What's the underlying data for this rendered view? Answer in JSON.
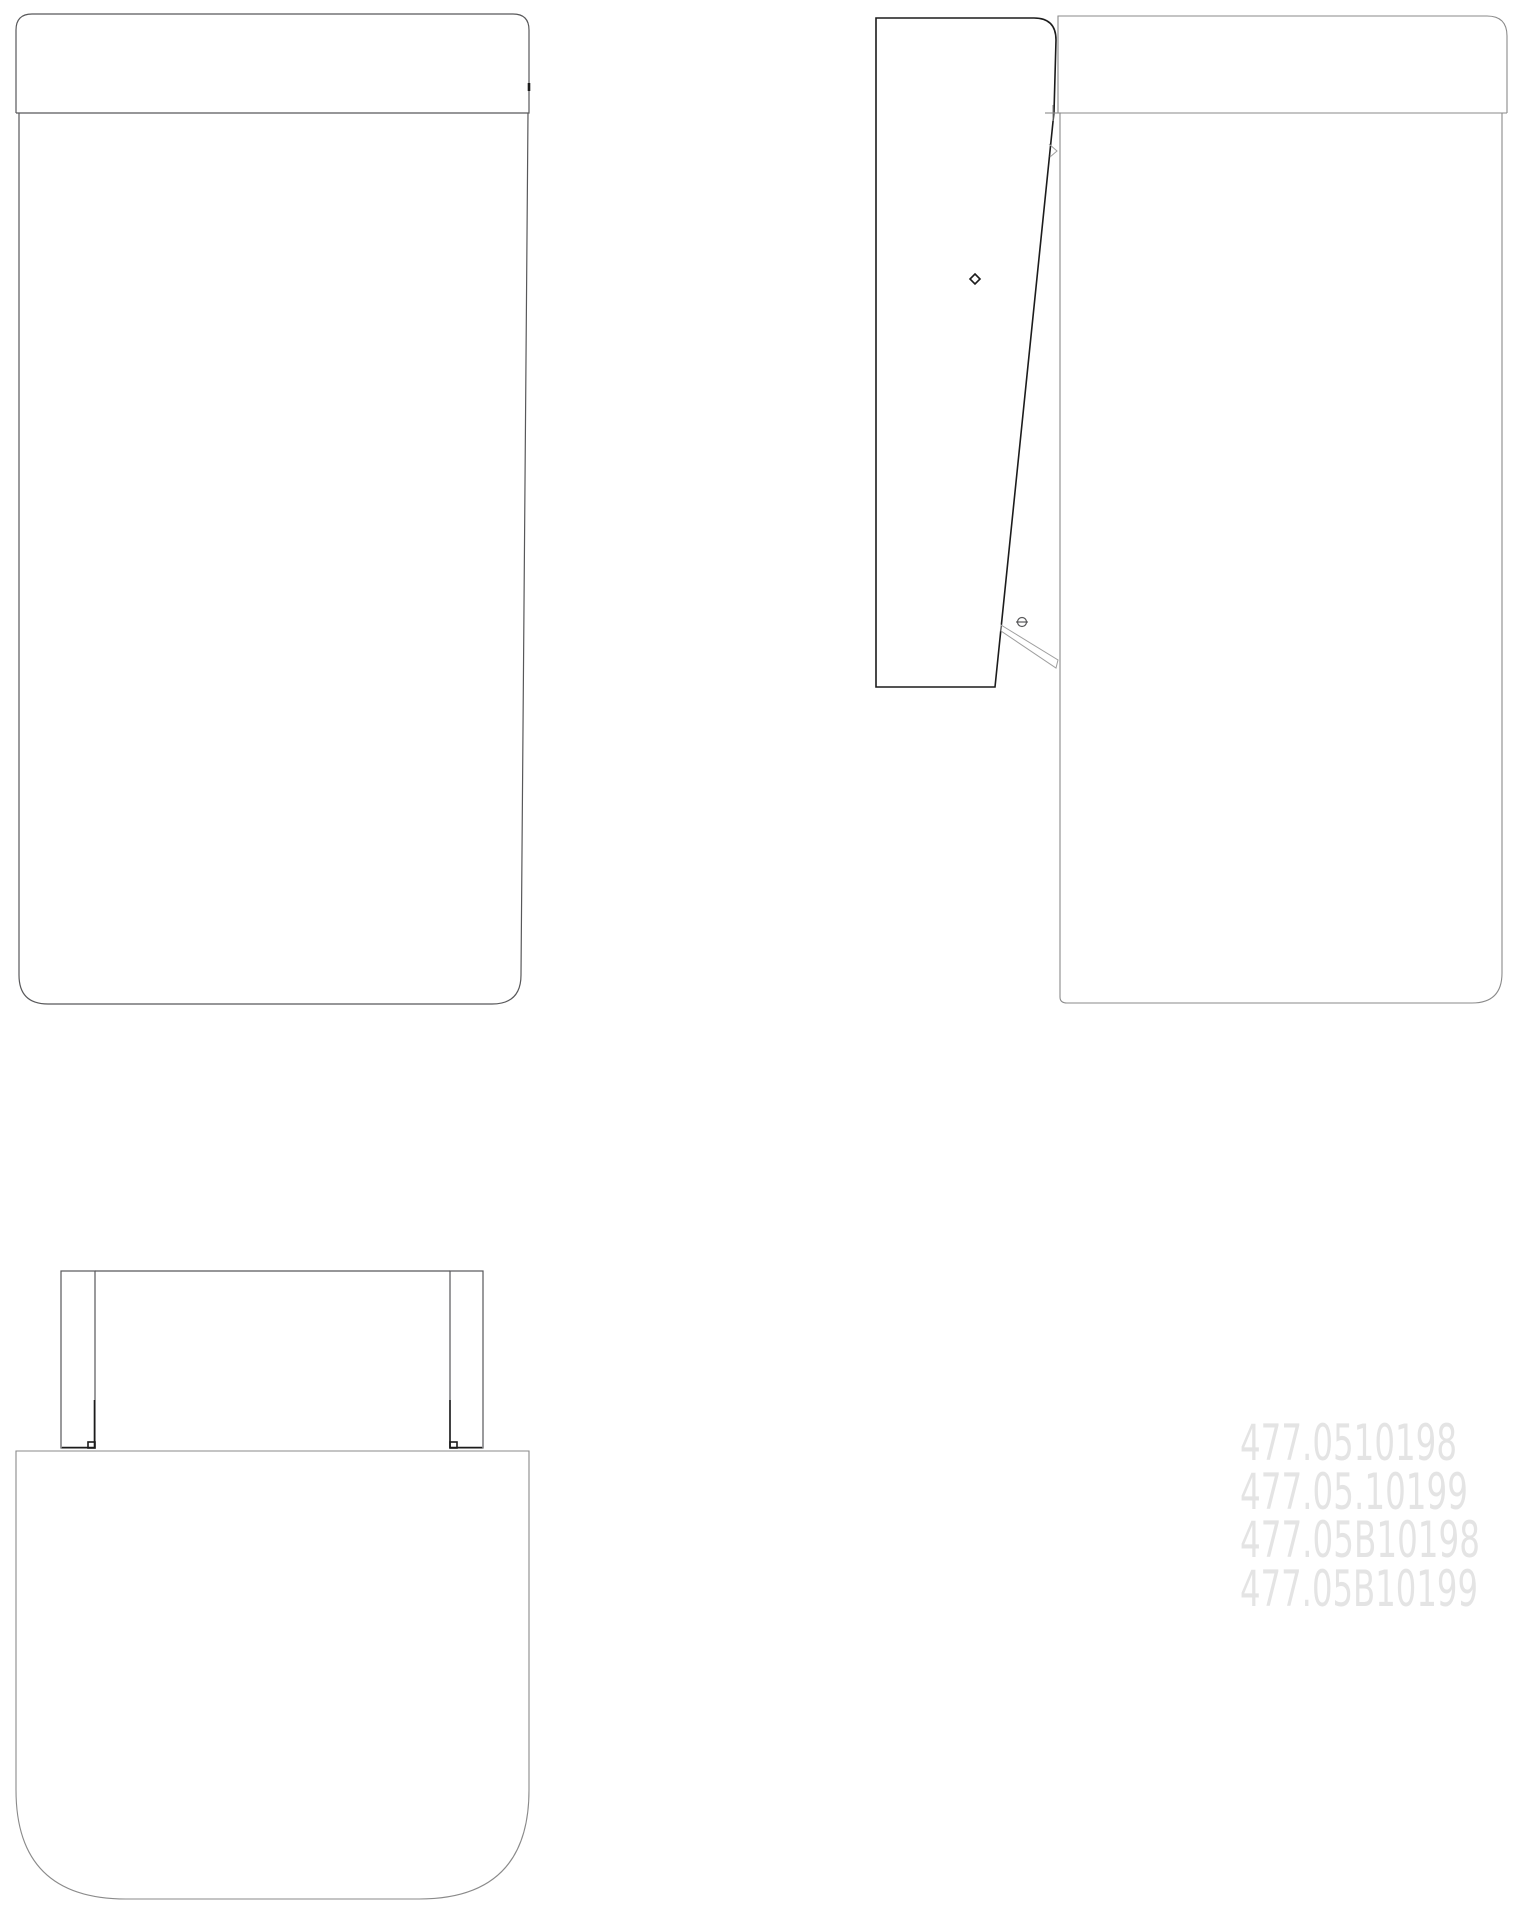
{
  "drawing": {
    "description": "three-view technical drawing of wall cabinet with tilt-open door",
    "part_numbers": [
      "477.0510198",
      "477.05.10199",
      "477.05B10198",
      "477.05B10199"
    ]
  },
  "colors": {
    "background": "#ffffff",
    "line-medium": "#58585a",
    "line-dark": "#1c1c1c",
    "line-gray": "#8a8a8a",
    "line-light": "#9f9f9f",
    "watermark-text": "#e4e4e4"
  }
}
